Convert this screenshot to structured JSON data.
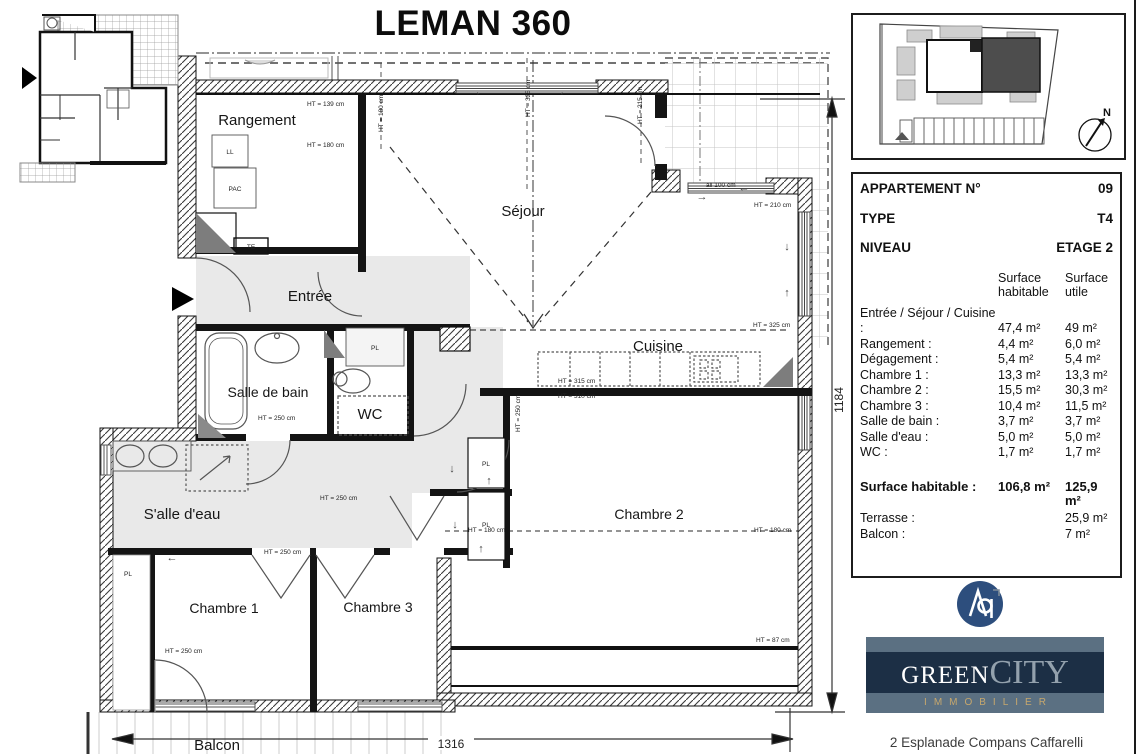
{
  "title": "LEMAN 360",
  "site_plan": {
    "compass_label": "N"
  },
  "info_panel": {
    "header_rows": [
      {
        "label": "APPARTEMENT N°",
        "value": "09"
      },
      {
        "label": "TYPE",
        "value": "T4"
      },
      {
        "label": "NIVEAU",
        "value": "ETAGE 2"
      }
    ],
    "col_headers": {
      "hab": "Surface habitable",
      "utile": "Surface utile"
    },
    "area_rows": [
      {
        "label": "Entrée / Séjour / Cuisine :",
        "hab": "47,4 m²",
        "utile": "49 m²"
      },
      {
        "label": "Rangement :",
        "hab": "4,4 m²",
        "utile": "6,0 m²"
      },
      {
        "label": "Dégagement :",
        "hab": "5,4 m²",
        "utile": "5,4 m²"
      },
      {
        "label": "Chambre 1 :",
        "hab": "13,3 m²",
        "utile": "13,3 m²"
      },
      {
        "label": "Chambre 2 :",
        "hab": "15,5 m²",
        "utile": "30,3 m²"
      },
      {
        "label": "Chambre 3 :",
        "hab": "10,4 m²",
        "utile": "11,5 m²"
      },
      {
        "label": "Salle de bain :",
        "hab": "3,7 m²",
        "utile": "3,7 m²"
      },
      {
        "label": "Salle d'eau :",
        "hab": "5,0 m²",
        "utile": "5,0 m²"
      },
      {
        "label": "WC :",
        "hab": "1,7 m²",
        "utile": "1,7 m²"
      }
    ],
    "total_row": {
      "label": "Surface habitable :",
      "hab": "106,8 m²",
      "utile": "125,9 m²"
    },
    "extra_rows": [
      {
        "label": "Terrasse :",
        "hab": "",
        "utile": "25,9 m²"
      },
      {
        "label": "Balcon :",
        "hab": "",
        "utile": "7 m²"
      }
    ]
  },
  "plan": {
    "rooms": [
      {
        "t": "Rangement"
      },
      {
        "t": "Séjour"
      },
      {
        "t": "Entrée"
      },
      {
        "t": "Cuisine"
      },
      {
        "t": "Salle de bain"
      },
      {
        "t": "WC"
      },
      {
        "t": "S'alle d'eau"
      },
      {
        "t": "Chambre 1"
      },
      {
        "t": "Chambre 3"
      },
      {
        "t": "Chambre 2"
      },
      {
        "t": "Balcon"
      }
    ],
    "dims": [
      {
        "t": "HT = 139 cm"
      },
      {
        "t": "HT = 180 cm"
      },
      {
        "t": "HT = 180 cm"
      },
      {
        "t": "HT = 325 cm"
      },
      {
        "t": "HT = 215 cm"
      },
      {
        "t": "all 100 cm"
      },
      {
        "t": "HT = 210 cm"
      },
      {
        "t": "HT = 325 cm"
      },
      {
        "t": "HT = 315 cm"
      },
      {
        "t": "HT = 310 cm"
      },
      {
        "t": "HT = 250 cm"
      },
      {
        "t": "HT = 250 cm"
      },
      {
        "t": "HT = 250 cm"
      },
      {
        "t": "HT = 250 cm"
      },
      {
        "t": "HT = 250 cm"
      },
      {
        "t": "HT = 180 cm"
      },
      {
        "t": "HT = 180 cm"
      },
      {
        "t": "HT = 87 cm"
      },
      {
        "t": "1316"
      },
      {
        "t": "1184"
      }
    ],
    "fixtures": [
      {
        "t": "LL"
      },
      {
        "t": "PAC"
      },
      {
        "t": "TE"
      },
      {
        "t": "PL"
      },
      {
        "t": "PL"
      },
      {
        "t": "PL"
      },
      {
        "t": "PL"
      }
    ],
    "arrows": [
      {
        "g": "→"
      },
      {
        "g": "←"
      },
      {
        "g": "←"
      },
      {
        "g": "→"
      },
      {
        "g": "↓"
      },
      {
        "g": "↑"
      },
      {
        "g": "←"
      },
      {
        "g": "↓"
      },
      {
        "g": "↑"
      },
      {
        "g": "↓"
      },
      {
        "g": "↑"
      }
    ]
  },
  "branding": {
    "monogram": "Ap",
    "logo": {
      "green": "GREEN",
      "city": "CITY",
      "tagline": "IMMOBILIER"
    },
    "address": "2 Esplanade Compans Caffarelli"
  }
}
